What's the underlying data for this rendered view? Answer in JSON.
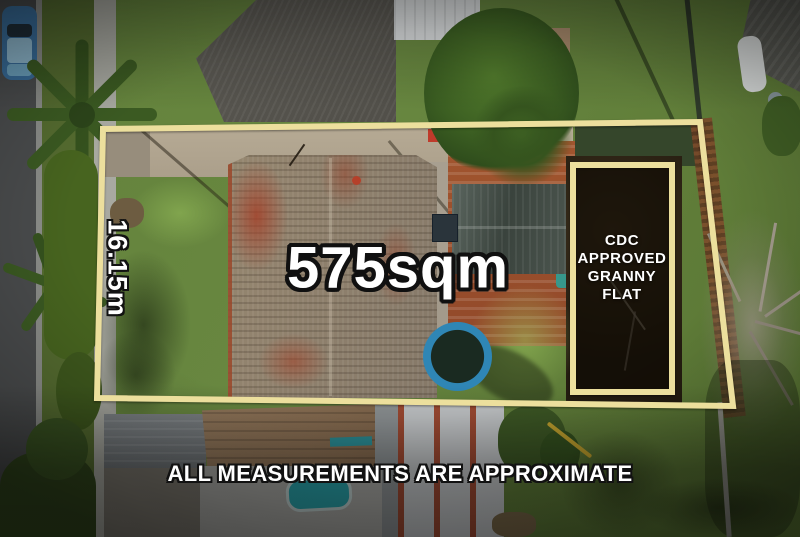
{
  "overlay": {
    "area_label": "575sqm",
    "side_measurement": "16.15m",
    "granny_flat_lines": [
      "CDC",
      "APPROVED",
      "GRANNY",
      "FLAT"
    ],
    "disclaimer": "ALL MEASUREMENTS ARE APPROXIMATE",
    "colors": {
      "boundary_line": "#ecdf9d",
      "granny_flat_fill": "rgba(10,7,0,0.45)",
      "label_text": "#ffffff",
      "label_outline": "#101010"
    }
  }
}
